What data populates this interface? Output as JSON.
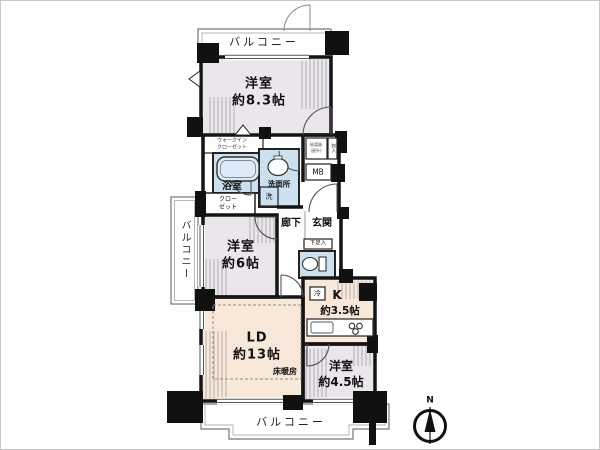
{
  "labels": {
    "balcony_top": "バルコニー",
    "balcony_left": "バルコニー",
    "balcony_bottom": "バルコニー",
    "bedroom83_name": "洋室",
    "bedroom83_size": "約8.3帖",
    "bedroom6_name": "洋室",
    "bedroom6_size": "約6帖",
    "bedroom45_name": "洋室",
    "bedroom45_size": "約4.5帖",
    "ld_name": "LD",
    "ld_size": "約13帖",
    "floor_heating": "床暖房",
    "kitchen_name": "K",
    "kitchen_size": "約3.5帖",
    "bath": "浴室",
    "washroom": "洗面所",
    "hall": "廊下",
    "entrance": "玄関",
    "wic_line1": "ウォークイン",
    "wic_line2": "クローゼット",
    "closet_line1": "クロー",
    "closet_line2": "ゼット",
    "shoe_cabinet": "下足入",
    "meter_box": "MB",
    "heater_line1": "給湯器",
    "heater_line2": "(屋外)",
    "storage": "物入",
    "washer": "洗",
    "fridge": "冷",
    "north": "N"
  },
  "colors": {
    "bedroom_fill": "#ebe6ec",
    "living_fill": "#f7e8d9",
    "wet_area_fill": "#cbe1f0",
    "wall": "#141414",
    "balcony_outline": "#777777"
  }
}
